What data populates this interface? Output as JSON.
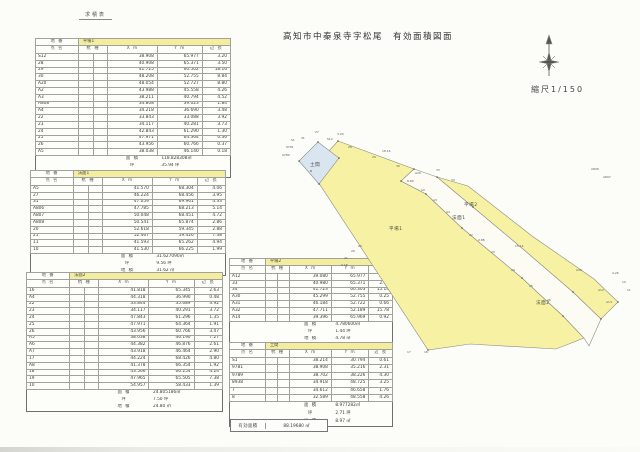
{
  "page": {
    "doc_label": "求積表",
    "title": "高知市中秦泉寺字松尾　有効面積図面",
    "scale_label": "縮尺1/150"
  },
  "columns": {
    "parcel_label": "地 番",
    "name": "点 名",
    "stake": "杭 種",
    "x": "X m",
    "y": "Y m",
    "len": "辺 長"
  },
  "tables": [
    {
      "parcel": "平場1",
      "rows": [
        [
          "S12",
          "38.908",
          "65.977",
          "3.20"
        ],
        [
          "28",
          "40.908",
          "65.371",
          "3.50"
        ],
        [
          "29",
          "41.725",
          "60.502",
          "18.16"
        ],
        [
          "30",
          "48.208",
          "52.755",
          "8.84"
        ],
        [
          "A20",
          "48.054",
          "52.727",
          "8.80"
        ],
        [
          "A2",
          "43.988",
          "45.558",
          "4.26"
        ],
        [
          "A3",
          "38.211",
          "40.794",
          "4.52"
        ],
        [
          "A808",
          "34.808",
          "39.023",
          "1.84"
        ],
        [
          "A4",
          "34.218",
          "36.690",
          "3.48"
        ],
        [
          "22",
          "33.843",
          "33.088",
          "3.92"
        ],
        [
          "23",
          "34.117",
          "40.281",
          "3.73"
        ],
        [
          "24",
          "42.843",
          "61.290",
          "1.30"
        ],
        [
          "25",
          "47.971",
          "64.364",
          "0.36"
        ],
        [
          "26",
          "43.956",
          "60.766",
          "0.37"
        ],
        [
          "A5",
          "38.038",
          "46.140",
          "0.18"
        ]
      ],
      "totals": [
        [
          "面 積",
          "118.828308㎡"
        ],
        [
          "坪",
          "35.94 坪"
        ],
        [
          "地 積",
          "118.82 ㎡"
        ]
      ]
    },
    {
      "parcel": "法面1",
      "rows": [
        [
          "A5",
          "41.570",
          "68.304",
          "4.06"
        ],
        [
          "27",
          "46.224",
          "68.456",
          "3.95"
        ],
        [
          "31",
          "47.059",
          "69.961",
          "4.33"
        ],
        [
          "A806",
          "47.785",
          "68.213",
          "5.14"
        ],
        [
          "A807",
          "50.048",
          "68.451",
          "4.72"
        ],
        [
          "A808",
          "50.541",
          "65.874",
          "2.86"
        ],
        [
          "20",
          "52.618",
          "59.345",
          "2.88"
        ],
        [
          "21",
          "52.467",
          "59.426",
          "7.38"
        ],
        [
          "11",
          "41.593",
          "65.262",
          "4.94"
        ],
        [
          "10",
          "41.530",
          "66.225",
          "1.99"
        ]
      ],
      "totals": [
        [
          "面 積",
          "31.627090㎡"
        ],
        [
          "坪",
          "9.56 坪"
        ],
        [
          "地 積",
          "31.62 ㎡"
        ]
      ]
    },
    {
      "parcel": "法面2",
      "rows": [
        [
          "16",
          "41.818",
          "65.345",
          "2.63"
        ],
        [
          "A4",
          "44.318",
          "36.990",
          "0.48"
        ],
        [
          "22",
          "33.844",
          "35.689",
          "3.92"
        ],
        [
          "23",
          "34.117",
          "40.291",
          "3.72"
        ],
        [
          "24",
          "47.843",
          "61.296",
          "1.35"
        ],
        [
          "25",
          "47.971",
          "64.364",
          "1.91"
        ],
        [
          "26",
          "43.956",
          "60.766",
          "3.47"
        ],
        [
          "A5",
          "38.038",
          "46.190",
          "7.27"
        ],
        [
          "A6",
          "44.382",
          "46.876",
          "2.61"
        ],
        [
          "A7",
          "43.918",
          "46.464",
          "2.90"
        ],
        [
          "17",
          "44.224",
          "68.426",
          "4.80"
        ],
        [
          "A8",
          "41.378",
          "66.354",
          "1.92"
        ],
        [
          "18",
          "43.566",
          "66.254",
          "4.24"
        ],
        [
          "19",
          "47.965",
          "65.505",
          "7.38"
        ],
        [
          "10",
          "54.957",
          "58.433",
          "1.39"
        ]
      ],
      "totals": [
        [
          "面 積",
          "24.805186㎡"
        ],
        [
          "坪",
          "7.50 坪"
        ],
        [
          "地 積",
          "24.80 ㎡"
        ]
      ]
    },
    {
      "parcel": "平場2",
      "rows": [
        [
          "A12",
          "39.080",
          "65.977",
          "3.38"
        ],
        [
          "33",
          "40.980",
          "65.371",
          "2.03"
        ],
        [
          "34",
          "41.723",
          "60.303",
          "15.14"
        ],
        [
          "A30",
          "45.299",
          "52.755",
          "0.25"
        ],
        [
          "A31",
          "46.184",
          "52.722",
          "0.66"
        ],
        [
          "A32",
          "47.711",
          "52.189",
          "15.78"
        ],
        [
          "A14",
          "39.396",
          "65.969",
          "0.92"
        ]
      ],
      "totals": [
        [
          "面 積",
          "4.780600㎡"
        ],
        [
          "坪",
          "1.44 坪"
        ],
        [
          "地 積",
          "4.78 ㎡"
        ]
      ]
    },
    {
      "parcel": "土間",
      "rows": [
        [
          "S1",
          "38.214",
          "30.794",
          "0.61"
        ],
        [
          "9781",
          "38.908",
          "35.216",
          "2.31"
        ],
        [
          "9789",
          "38.702",
          "38.226",
          "4.30"
        ],
        [
          "8938",
          "34.918",
          "48.725",
          "3.25"
        ],
        [
          "7",
          "34.612",
          "46.658",
          "1.76"
        ],
        [
          "8",
          "32.589",
          "48.558",
          "4.26"
        ]
      ],
      "totals": [
        [
          "面 積",
          "8.977282㎡"
        ],
        [
          "坪",
          "2.71 坪"
        ],
        [
          "地 積",
          "8.97 ㎡"
        ]
      ]
    }
  ],
  "summary": {
    "label": "有効面積",
    "value": "88.19680 ㎡"
  },
  "map": {
    "colors": {
      "flat": "#f7f2a3",
      "slope": "#fcfcf4",
      "blue": "#d9e6f0"
    },
    "labels": [
      {
        "t": "土間",
        "x": 310,
        "y": 166,
        "cls": "p"
      },
      {
        "t": "平場1",
        "x": 389,
        "y": 230,
        "cls": "p"
      },
      {
        "t": "法面1",
        "x": 452,
        "y": 219,
        "cls": "p"
      },
      {
        "t": "平場2",
        "x": 464,
        "y": 206,
        "cls": "p"
      },
      {
        "t": "法面2",
        "x": 536,
        "y": 304,
        "cls": "p"
      },
      {
        "t": "S12",
        "x": 327,
        "y": 140,
        "cls": "m"
      },
      {
        "t": "28",
        "x": 348,
        "y": 148,
        "cls": "m"
      },
      {
        "t": "29",
        "x": 372,
        "y": 158,
        "cls": "m"
      },
      {
        "t": "30",
        "x": 396,
        "y": 167,
        "cls": "m"
      },
      {
        "t": "A20",
        "x": 415,
        "y": 174,
        "cls": "m"
      },
      {
        "t": "3.20",
        "x": 337,
        "y": 135,
        "cls": "m"
      },
      {
        "t": "18.16",
        "x": 382,
        "y": 152,
        "cls": "m"
      },
      {
        "t": "8.84",
        "x": 407,
        "y": 182,
        "cls": "m"
      },
      {
        "t": "A2",
        "x": 421,
        "y": 191,
        "cls": "m"
      },
      {
        "t": "A3",
        "x": 433,
        "y": 201,
        "cls": "m"
      },
      {
        "t": "A4",
        "x": 446,
        "y": 213,
        "cls": "m"
      },
      {
        "t": "22",
        "x": 469,
        "y": 236,
        "cls": "m"
      },
      {
        "t": "23",
        "x": 491,
        "y": 253,
        "cls": "m"
      },
      {
        "t": "24",
        "x": 511,
        "y": 271,
        "cls": "m"
      },
      {
        "t": "25",
        "x": 529,
        "y": 287,
        "cls": "m"
      },
      {
        "t": "26",
        "x": 547,
        "y": 301,
        "cls": "m"
      },
      {
        "t": "27",
        "x": 315,
        "y": 133,
        "cls": "m"
      },
      {
        "t": "31",
        "x": 301,
        "y": 139,
        "cls": "m"
      },
      {
        "t": "33",
        "x": 436,
        "y": 171,
        "cls": "m"
      },
      {
        "t": "34",
        "x": 451,
        "y": 181,
        "cls": "m"
      },
      {
        "t": "15.14",
        "x": 515,
        "y": 247,
        "cls": "m"
      },
      {
        "t": "A30",
        "x": 576,
        "y": 271,
        "cls": "m"
      },
      {
        "t": "A12",
        "x": 598,
        "y": 291,
        "cls": "m"
      },
      {
        "t": "A14",
        "x": 606,
        "y": 303,
        "cls": "m"
      },
      {
        "t": "A806",
        "x": 591,
        "y": 170,
        "cls": "m"
      },
      {
        "t": "A807",
        "x": 603,
        "y": 178,
        "cls": "m"
      },
      {
        "t": "10",
        "x": 622,
        "y": 283,
        "cls": "m"
      },
      {
        "t": "11",
        "x": 627,
        "y": 291,
        "cls": "m"
      },
      {
        "t": "A5",
        "x": 358,
        "y": 247,
        "cls": "m"
      },
      {
        "t": "20",
        "x": 351,
        "y": 252,
        "cls": "m"
      },
      {
        "t": "21",
        "x": 344,
        "y": 259,
        "cls": "m"
      },
      {
        "t": "0.18",
        "x": 341,
        "y": 266,
        "cls": "m"
      },
      {
        "t": "17",
        "x": 407,
        "y": 353,
        "cls": "m"
      },
      {
        "t": "18",
        "x": 424,
        "y": 353,
        "cls": "m"
      },
      {
        "t": "S1",
        "x": 291,
        "y": 141,
        "cls": "m"
      },
      {
        "t": "9781",
        "x": 286,
        "y": 148,
        "cls": "m"
      },
      {
        "t": "9789",
        "x": 282,
        "y": 156,
        "cls": "m"
      },
      {
        "t": "4.26",
        "x": 612,
        "y": 274,
        "cls": "m"
      },
      {
        "t": "2.88",
        "x": 478,
        "y": 241,
        "cls": "m"
      }
    ]
  }
}
